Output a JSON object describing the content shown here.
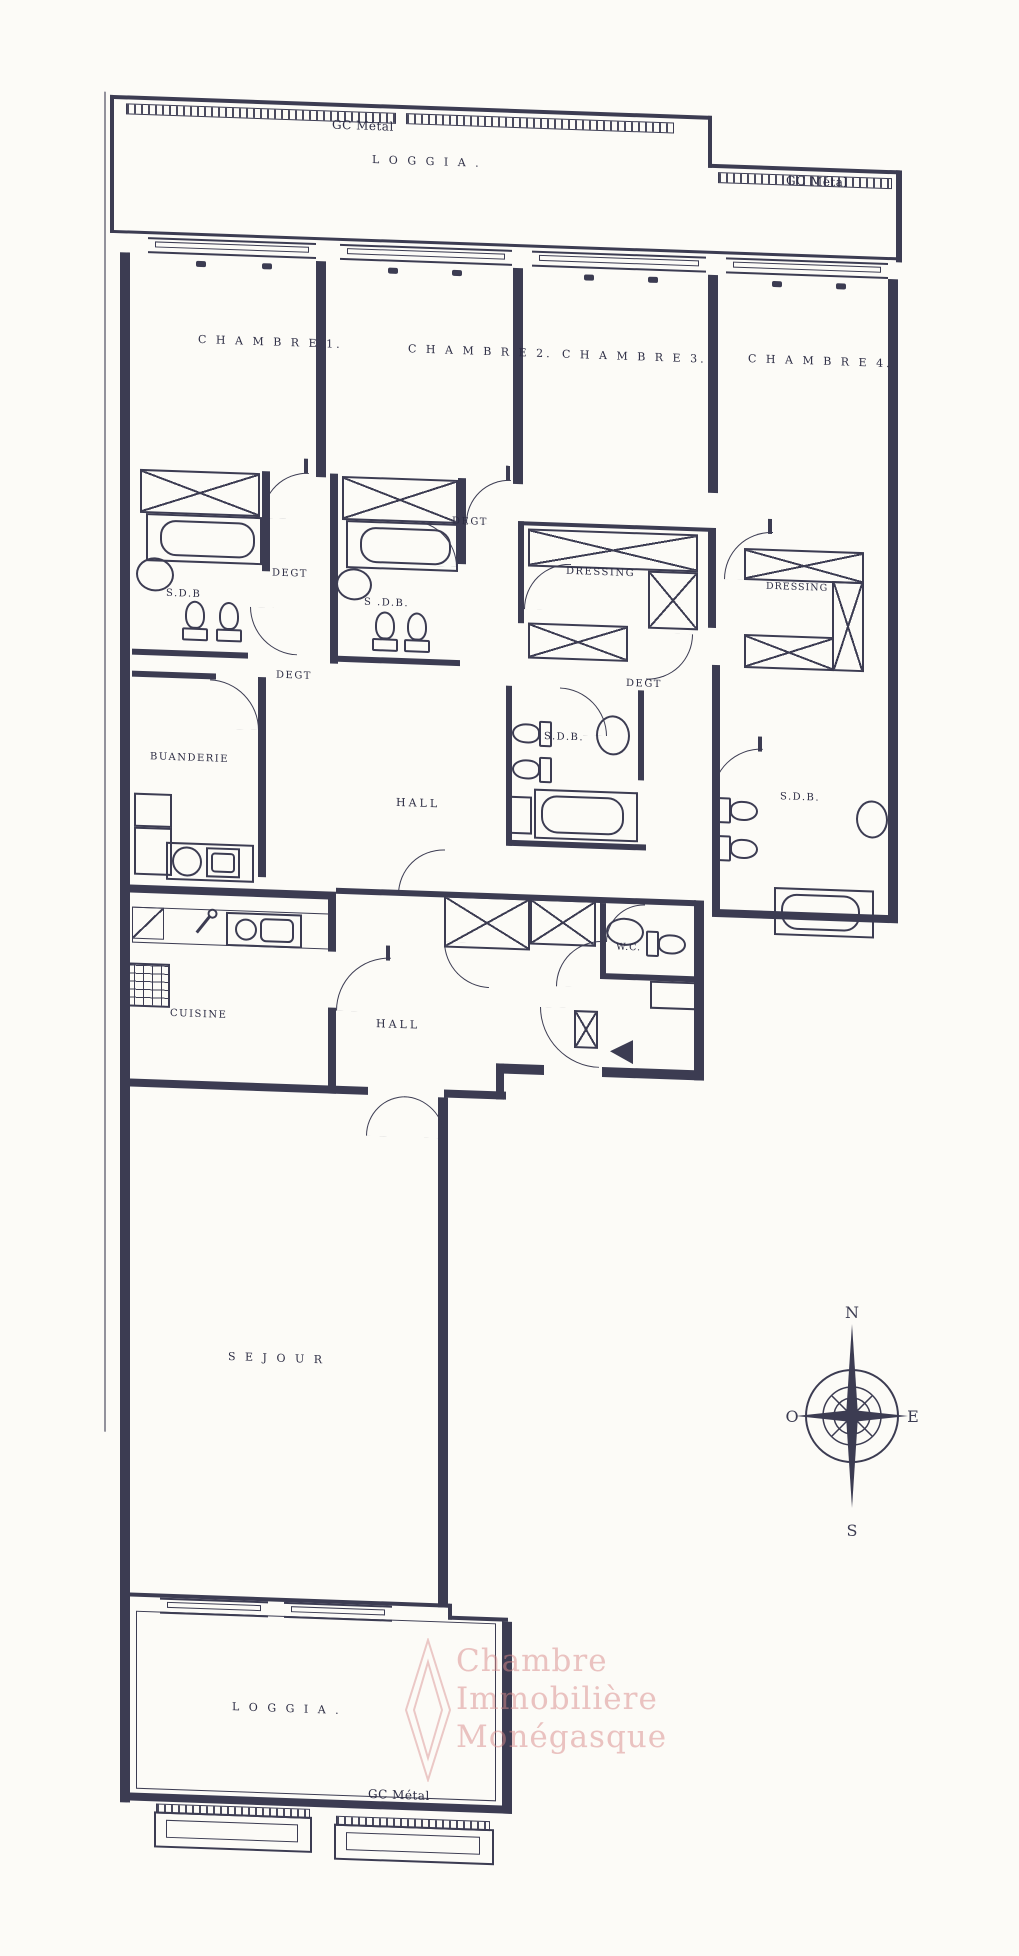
{
  "colors": {
    "ink": "#3c3c52",
    "paper": "#fcfbf7",
    "watermark": "#d88a8a"
  },
  "labels": {
    "gc_metal_top": "GC Métal",
    "loggia_top": "L O G G I A .",
    "gc_metal_right": "GC Métal",
    "chambre1": "C H A M B R E 1.",
    "chambre2": "C H A M B R E 2.",
    "chambre3": "C H A M B R E 3.",
    "chambre4": "C H A M B R E 4.",
    "degt_a": "DEGT",
    "degt_b": "DEGT",
    "degt_c": "DEGT",
    "degt_d": "DEGT",
    "sdb1": "S.D.B",
    "sdb2": "S .D.B.",
    "sdb3": "S.D.B.",
    "sdb4": "S.D.B.",
    "dressing3": "DRESSING",
    "dressing4": "DRESSING",
    "buanderie": "BUANDERIE",
    "hall1": "HALL",
    "hall2": "HALL",
    "wc": "W.C.",
    "cuisine": "CUISINE",
    "sejour": "S E J O U R",
    "loggia_bottom": "L O G G I A .",
    "gc_metal_bottom": "GC Métal"
  },
  "compass": {
    "n": "N",
    "s": "S",
    "e": "E",
    "o": "O"
  },
  "watermark": {
    "line1": "Chambre",
    "line2": "Immobilière",
    "line3": "Monégasque"
  }
}
